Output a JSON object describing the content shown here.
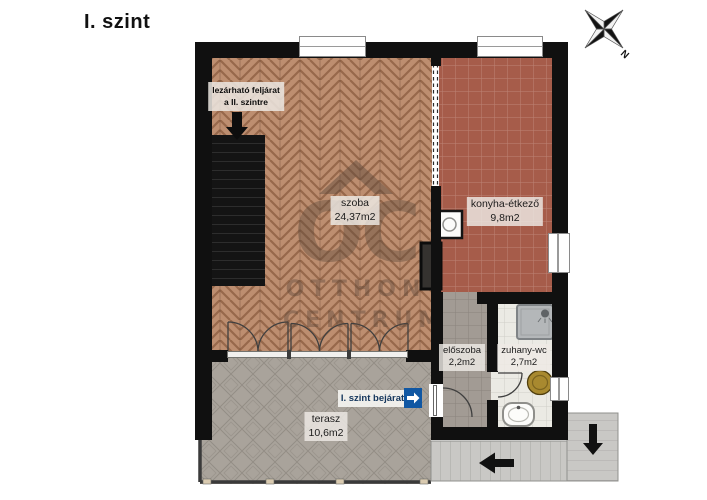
{
  "title": "I. szint",
  "compass": {
    "north_label": "N"
  },
  "watermark": {
    "monogram": "OC",
    "line1": "OTTHON",
    "line2": "CENTRUM"
  },
  "rooms": [
    {
      "id": "szoba",
      "name": "szoba",
      "area": "24,37m2"
    },
    {
      "id": "konyha",
      "name": "konyha-étkező",
      "area": "9,8m2"
    },
    {
      "id": "eloszoba",
      "name": "előszoba",
      "area": "2,2m2"
    },
    {
      "id": "zuhany",
      "name": "zuhany-wc",
      "area": "2,7m2"
    },
    {
      "id": "terasz",
      "name": "terasz",
      "area": "10,6m2"
    }
  ],
  "annotations": {
    "stairs_note_line1": "lezárható feljárat",
    "stairs_note_line2": "a II. szintre",
    "entrance_label": "I. szint bejárat"
  },
  "colors": {
    "accent_blue": "#1057a3",
    "wall": "#101010",
    "wood_floor": "#bd8e70",
    "kitchen_tile": "#a65c4a",
    "hallway_tile": "#a29b94",
    "bathroom_floor": "#ebeae4",
    "terrace_tile": "#a9a39b",
    "exterior_stairs": "#c9c8c5",
    "toilet_seat": "#a8892f"
  }
}
